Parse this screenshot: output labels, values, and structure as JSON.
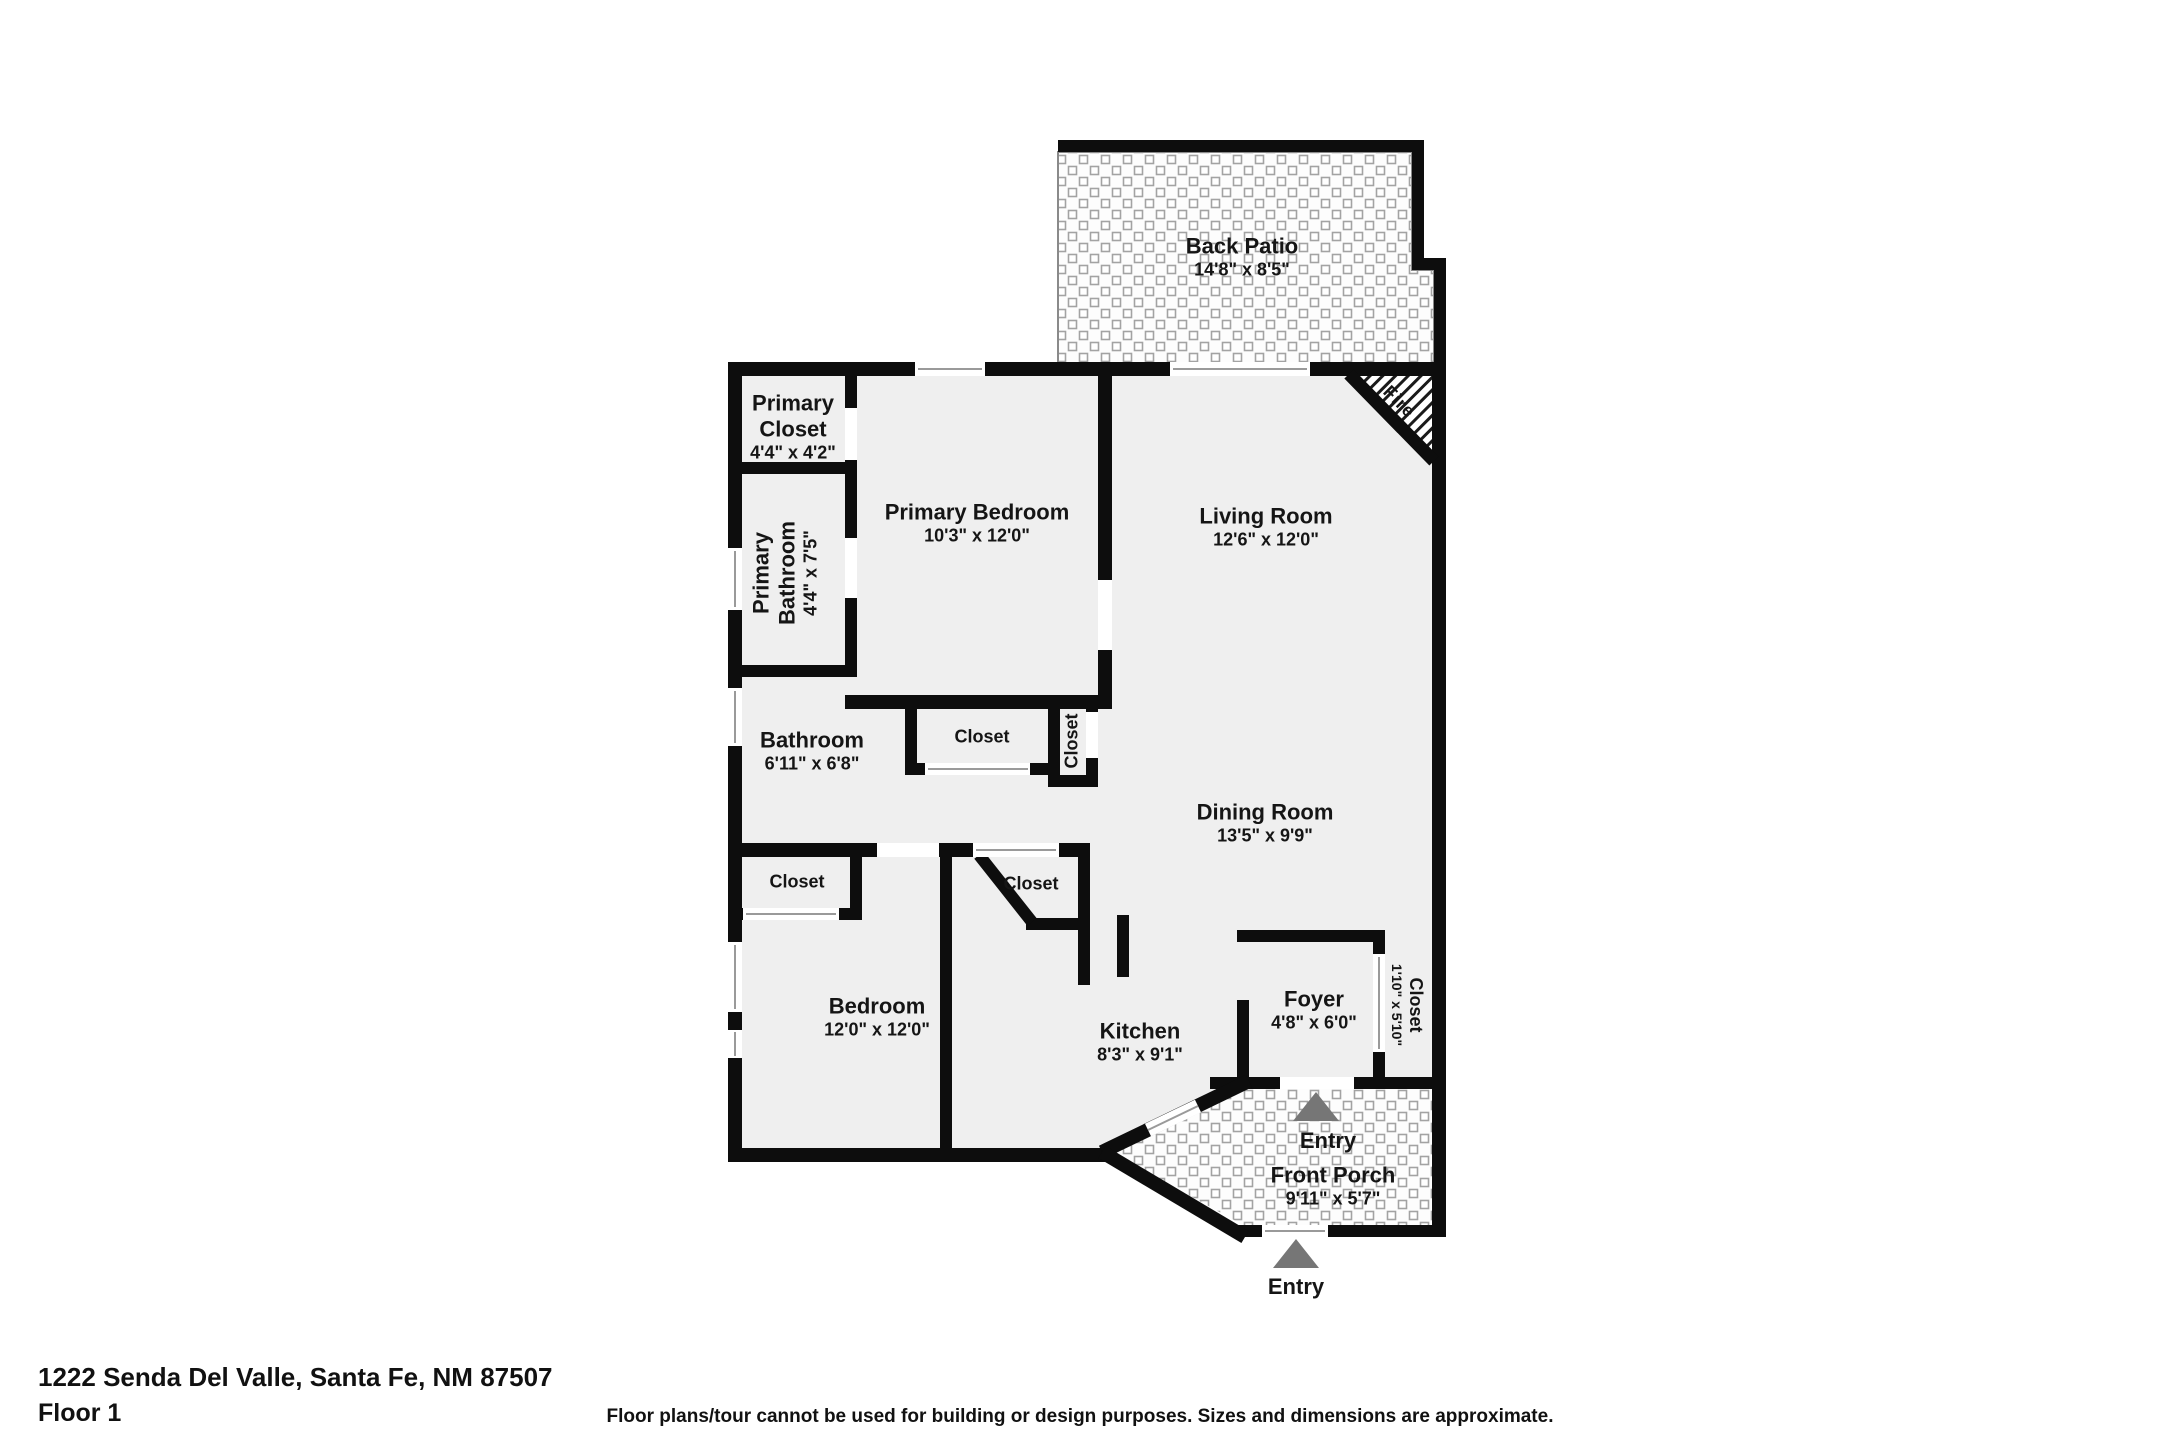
{
  "plan": {
    "fireplace_label": "Fire",
    "rooms": {
      "back_patio": {
        "name": "Back Patio",
        "dims": "14'8\" x 8'5\""
      },
      "primary_closet": {
        "name": "Primary Closet",
        "dims": "4'4\" x 4'2\""
      },
      "primary_bedroom": {
        "name": "Primary Bedroom",
        "dims": "10'3\" x 12'0\""
      },
      "living_room": {
        "name": "Living Room",
        "dims": "12'6\" x 12'0\""
      },
      "primary_bathroom": {
        "name": "Primary Bathroom",
        "dims": "4'4\" x 7'5\""
      },
      "bathroom": {
        "name": "Bathroom",
        "dims": "6'11\" x 6'8\""
      },
      "closet_hall": {
        "name": "Closet"
      },
      "closet_linen": {
        "name": "Closet"
      },
      "dining_room": {
        "name": "Dining Room",
        "dims": "13'5\" x 9'9\""
      },
      "closet_bedroom": {
        "name": "Closet"
      },
      "closet_kitchen": {
        "name": "Closet"
      },
      "bedroom": {
        "name": "Bedroom",
        "dims": "12'0\" x 12'0\""
      },
      "kitchen": {
        "name": "Kitchen",
        "dims": "8'3\" x 9'1\""
      },
      "foyer": {
        "name": "Foyer",
        "dims": "4'8\" x 6'0\""
      },
      "closet_foyer": {
        "name": "Closet",
        "dims": "1'10\" x 5'10\""
      },
      "front_porch": {
        "entry": "Entry",
        "name": "Front Porch",
        "dims": "9'11\" x 5'7\""
      }
    },
    "entry_outside": "Entry"
  },
  "footer": {
    "address": "1222 Senda Del Valle, Santa Fe, NM 87507",
    "floor": "Floor 1",
    "disclaimer": "Floor plans/tour cannot be used for building or design purposes. Sizes and dimensions are approximate."
  },
  "colors": {
    "wall": "#0d0d0d",
    "floor": "#efefef",
    "patio_tile_line": "#a3a3a3",
    "entry_arrow": "#767676",
    "text": "#151515"
  }
}
